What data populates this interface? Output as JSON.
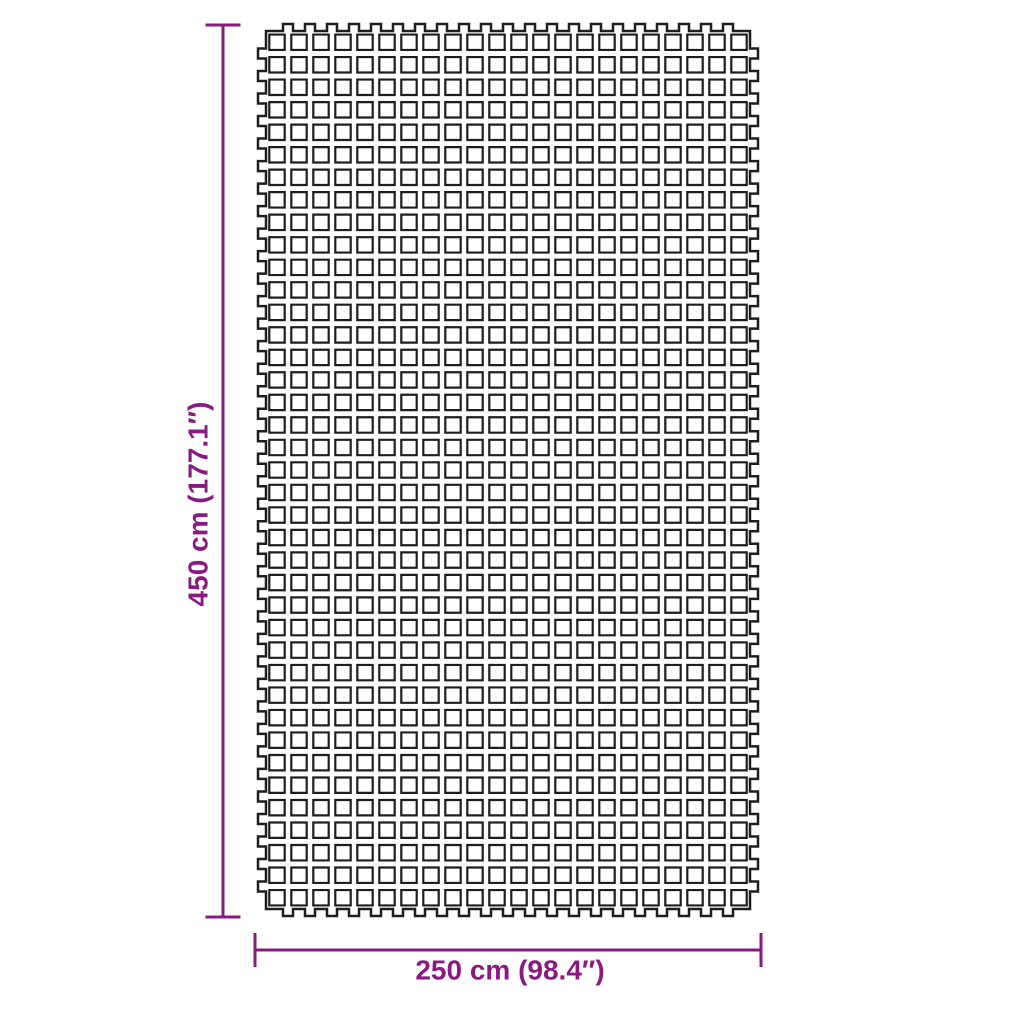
{
  "image": {
    "type": "product-dimension-diagram",
    "subject": "camping floor mat with interlocking grid pattern",
    "background_color": "#ffffff"
  },
  "dimension_labels": {
    "height": "450 cm (177.1″)",
    "width": "250 cm (98.4″)"
  },
  "style": {
    "dimension_color": "#8b1a80",
    "mat_outline_color": "#1e1e1e"
  },
  "mat": {
    "grid": {
      "columns": 22,
      "rows": 39
    },
    "geometry": {
      "x": 266,
      "y": 31,
      "width": 484,
      "height": 878,
      "square_size": 15.4,
      "tab_width": 10,
      "tab_out_x": 8,
      "tab_out_y": 7
    }
  },
  "dimension_lines": {
    "vertical": {
      "x": 223,
      "y1": 25,
      "y2": 917,
      "cap_half": 17.5,
      "label_cx": 198,
      "label_cy": 504
    },
    "horizontal": {
      "y": 950,
      "x1": 255,
      "x2": 761,
      "cap_half": 17,
      "label_cx": 510,
      "label_cy": 970
    }
  }
}
